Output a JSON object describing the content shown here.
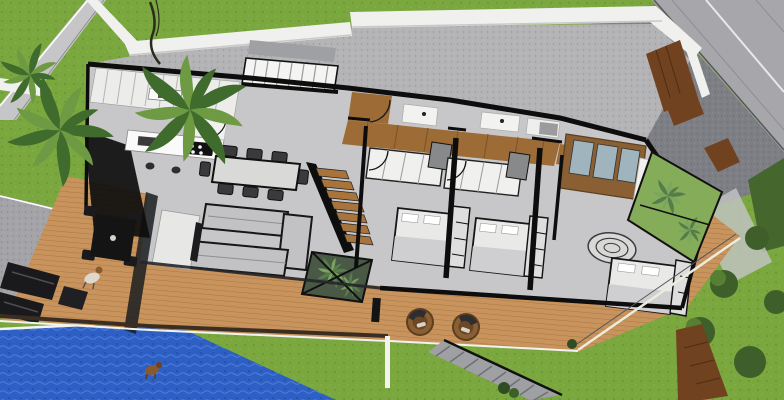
{
  "scene": {
    "type": "3d-architectural-render",
    "style": "SketchUp-style aerial cutaway (roof removed) of a modern single-story house",
    "view": "high-angle isometric from the south-west",
    "house": {
      "rooms": [
        {
          "name": "kitchen",
          "features": [
            "white cabinet run along north wall",
            "island with black 4-burner cooktop and sink",
            "two bar stools",
            "dark glass west facade"
          ]
        },
        {
          "name": "dining-area",
          "features": [
            "rectangular table",
            "8 black chairs"
          ]
        },
        {
          "name": "living-room",
          "features": [
            "two gray L-shaped sofas facing each other",
            "white TV unit with dark screen facing the room"
          ]
        },
        {
          "name": "entry-staircase",
          "features": [
            "white steps along north wall"
          ]
        },
        {
          "name": "wood-staircase",
          "features": [
            "wooden treads with black railing",
            "glass-walled garden void below"
          ]
        },
        {
          "name": "hallway",
          "features": [
            "warm wood floor strip serving bedrooms"
          ]
        },
        {
          "name": "bathroom",
          "features": [
            "white vanities and shower blocks along north strip"
          ]
        },
        {
          "name": "bedroom-1",
          "features": [
            "double bed with shelf headboard",
            "white sliding wardrobe",
            "swing door"
          ]
        },
        {
          "name": "bedroom-2",
          "features": [
            "double bed with shelf headboard",
            "white sliding wardrobe",
            "swing door"
          ]
        },
        {
          "name": "master-bedroom",
          "features": [
            "wood wardrobe with blue glass sliders",
            "white partition",
            "oval rug",
            "double bed with shelf headboard"
          ]
        }
      ],
      "counts": {
        "bedrooms": 3,
        "dining_chairs": 8,
        "lounge_chairs": 2,
        "staircases_inside": 2
      }
    },
    "outdoor": [
      "front lawn with two palm clusters and sketchy trunk",
      "diagonal sidewalk at top-left",
      "white perimeter walls",
      "street at top-right with lane seams",
      "dark speckled driveway",
      "wooden entry gate panels on the east wall",
      "glass courtyard garden beside master bedroom",
      "concrete side patio with black outdoor sofa set",
      "side deck with black outdoor dining table",
      "long wooden pool deck with plank boards",
      "two round rattan lounge chairs",
      "glass railing with white posts along the deck",
      "blue swimming pool at bottom-left",
      "exterior concrete stairs descending to rear lawn",
      "rear lawn with dark shrubs, hedge and wooden path"
    ],
    "creatures": [
      "dog standing at the pool edge",
      "small figure with dog on the side deck"
    ]
  },
  "palette": {
    "grass": "#7aa73e",
    "tree": "#3f5f2a",
    "treeLight": "#567f33",
    "hedge": "#45662c",
    "road": "#a7a7ab",
    "roadLine": "#e8e8e8",
    "sidewalk": "#c6c6c8",
    "patio": "#a4a4a8",
    "driveway": "#7e7f84",
    "wallWhite": "#f0f0ee",
    "wallShadow": "#c9c9c7",
    "wallBlack": "#0d0d0d",
    "passage": "#b4b4b6",
    "floor": "#c7c7c9",
    "floorDark": "#9fa0a3",
    "deck": "#c8935c",
    "deckLine": "#a87844",
    "hallWood": "#9c6b36",
    "woodDark": "#70421f",
    "stairWood": "#a9743c",
    "pool": "#2e5fc4",
    "poolLight": "#4e7fd8",
    "glassDark": "#1a1d20",
    "glassBlue": "#9fb4bd",
    "sofa": "#c2c2c4",
    "white": "#fafafa",
    "furnitureBlack": "#1a1a1c",
    "bedSheet": "#e9e9e7",
    "blanket": "#cfcfd1",
    "palm1": "#3f6b2d",
    "palm2": "#6d9a43",
    "rattan": "#8a5f33"
  }
}
